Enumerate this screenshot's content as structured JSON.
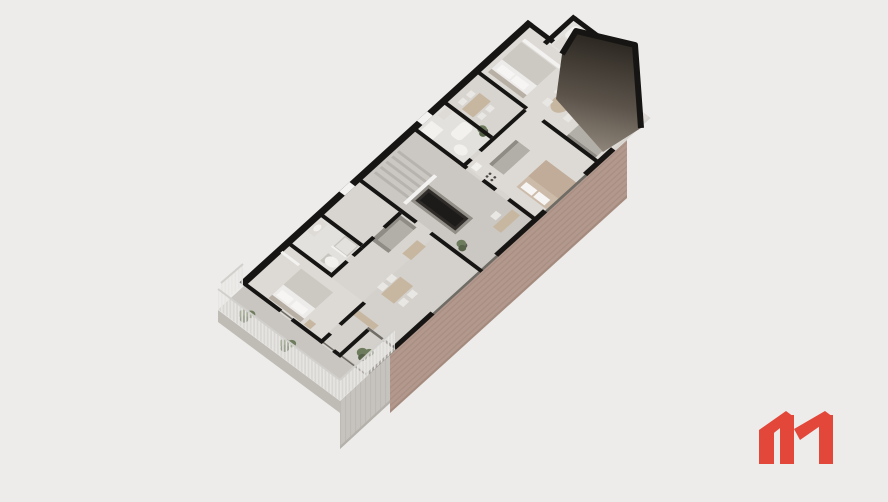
{
  "scene": {
    "type": "axonometric-floorplan-render",
    "description": "Aerial 3D cutaway render of a residential floor plan rotated diagonally on a plain light background",
    "rooms": [
      "bedroom-1",
      "bathroom-1",
      "living-room-1",
      "terrace",
      "balcony",
      "stairwell",
      "elevator-shaft",
      "corridor",
      "bathroom-2",
      "dining-area-2",
      "living-bedroom-2",
      "kitchenette",
      "bedroom-3",
      "dining-area-3",
      "living-room-3",
      "bathroom-wing"
    ],
    "elements": [
      "black-cut-walls",
      "glass-facade-line",
      "brick-facade",
      "concrete-facade",
      "slatted-railing",
      "potted-plants",
      "dark-sloped-roof",
      "stairs",
      "beds",
      "sofas",
      "dining-tables",
      "bath-fixtures"
    ]
  },
  "palette": {
    "background": "#edecea",
    "wall": "#161513",
    "glass": "#6f6b65",
    "floor": "#d8d5d0",
    "floor_bedroom": "#dddad5",
    "floor_living": "#d4d1cc",
    "floor_bath": "#e3e1dd",
    "floor_core": "#cbc8c3",
    "terrace": "#c9c6c1",
    "concrete": "#c6c3be",
    "concrete_dark": "#b4b1ab",
    "brick": "#b2988d",
    "brick_line": "#9d8275",
    "roof_dark": "#29251f",
    "roof_mid": "#5c544b",
    "roof_light": "#978d81",
    "rail_slat": "#e8e6e2",
    "rail_glass": "#edebe8",
    "rail_top": "#d2d0cc",
    "white_wall": "#f3f2f0",
    "stair_a": "#cbc8c3",
    "stair_b": "#b7b4af",
    "shaft_frame": "#918d87",
    "shaft": "#2e2b28",
    "shaft_core": "#1d1b19",
    "bed": "#edecea",
    "blanket": "#ccc8c2",
    "pillow": "#f6f5f3",
    "headboard": "#b8b0a5",
    "bed_beige": "#cdbba9",
    "blanket_beige": "#c0ac98",
    "sofa": "#b2aea8",
    "sofa_dark": "#8f8b85",
    "wood": "#c7b7a1",
    "chair": "#e9e7e3",
    "counter": "#dedbd6",
    "fixture": "#f2f1ee",
    "fixture_line": "#c9c6c0",
    "appliance": "#4a4744",
    "plant": "#6e7c5e",
    "plant_dark": "#566349",
    "pot": "#5f5b57"
  },
  "logo": {
    "name": "m-logo",
    "color": "#e2473a"
  }
}
